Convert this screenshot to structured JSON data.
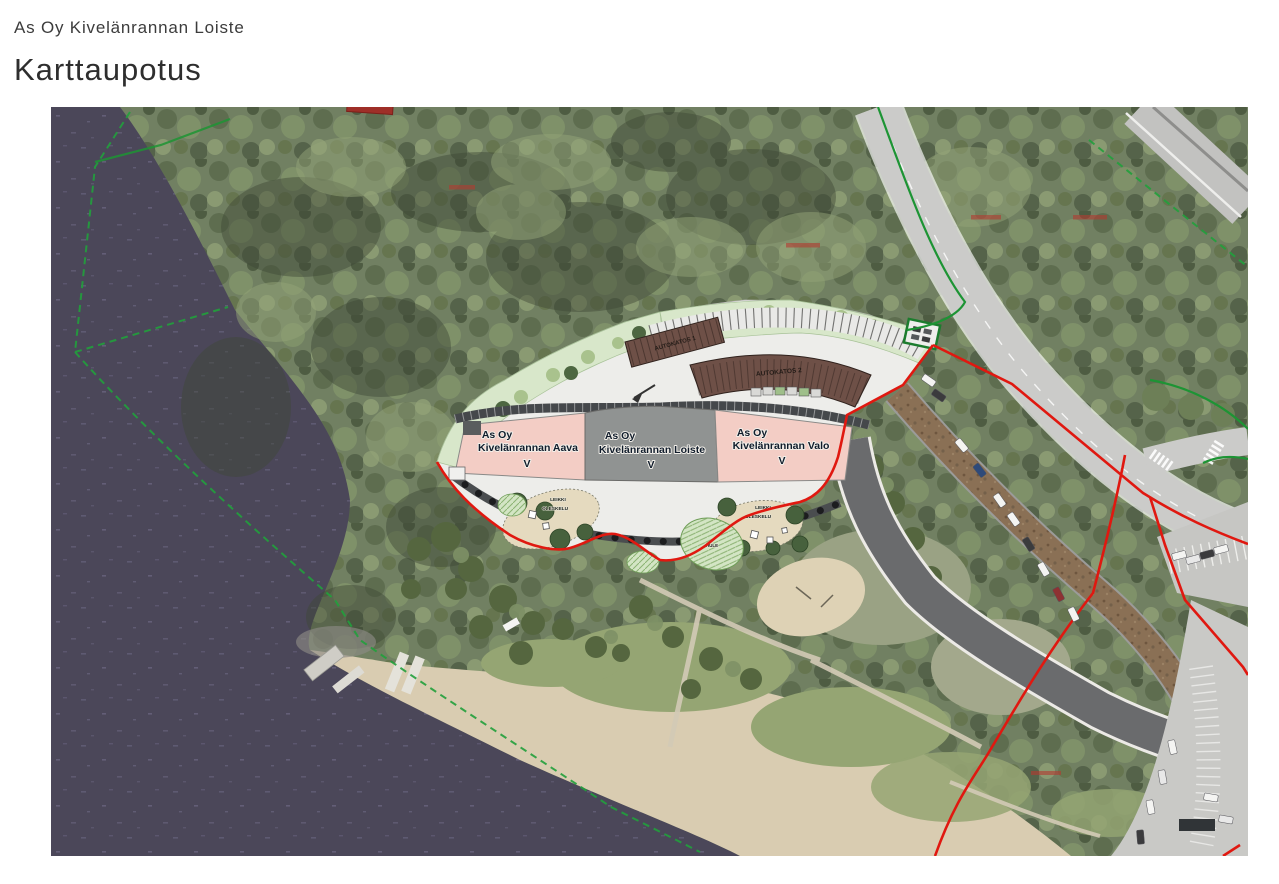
{
  "header": {
    "project": "As Oy Kivelänrannan Loiste",
    "title": "Karttaupotus"
  },
  "map_overlay": {
    "buildings": [
      {
        "line1": "As Oy",
        "line2": "Kivelänrannan Aava",
        "floors": "V"
      },
      {
        "line1": "As Oy",
        "line2": "Kivelänrannan Loiste",
        "floors": "V"
      },
      {
        "line1": "As Oy",
        "line2": "Kivelänrannan Valo",
        "floors": "V"
      }
    ],
    "carports": [
      {
        "label": "AUTOKATOS 1"
      },
      {
        "label": "AUTOKATOS 2"
      }
    ],
    "play_areas": [
      {
        "label1": "LEIKKI",
        "label2": "OLESKELU"
      },
      {
        "label1": "LEIKKI",
        "label2": "OLESKELU"
      }
    ],
    "stormwater": {
      "label": "HULE"
    },
    "colors": {
      "water": "#4b4759",
      "forest": "#718062",
      "sand": "#d9ccb1",
      "plan_background": "#ededea",
      "building_pink": "#f3cdc5",
      "building_gray": "#909392",
      "carport_brown": "#6e5047",
      "landscaping_green": "#d8e7ca",
      "boundary_red": "#e01810",
      "boundary_green": "#1d9434"
    }
  }
}
